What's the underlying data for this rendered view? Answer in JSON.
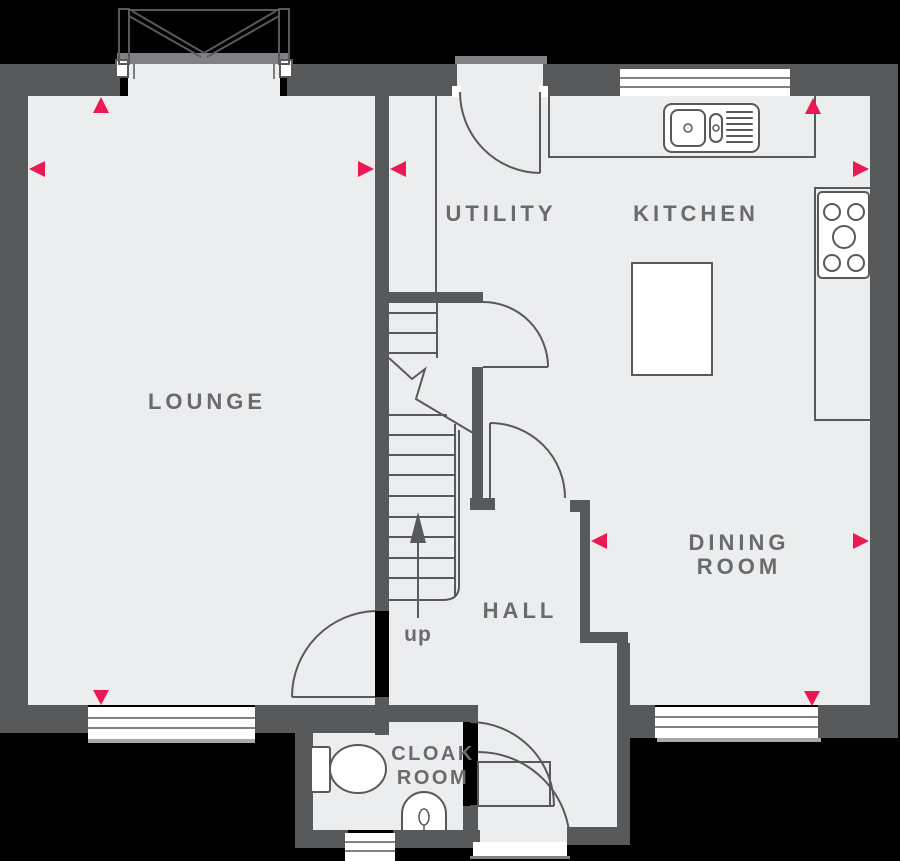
{
  "plan": {
    "type": "floorplan",
    "rooms": {
      "lounge": {
        "label": "LOUNGE"
      },
      "utility": {
        "label": "UTILITY"
      },
      "kitchen": {
        "label": "KITCHEN"
      },
      "dining": {
        "label_line1": "DINING",
        "label_line2": "ROOM"
      },
      "hall": {
        "label": "HALL"
      },
      "cloakroom": {
        "label_line1": "CLOAK",
        "label_line2": "ROOM"
      }
    },
    "stairs": {
      "direction_label": "up"
    },
    "fixtures": [
      "french-doors",
      "back-door",
      "front-door",
      "kitchen-sink",
      "hob",
      "kitchen-island",
      "worktop",
      "toilet",
      "basin",
      "stairs"
    ],
    "windows": [
      "kitchen-rear",
      "lounge-front",
      "dining-front",
      "cloakroom-front"
    ],
    "markers": [
      {
        "location": "lounge-top-wall",
        "direction": "up"
      },
      {
        "location": "lounge-left-wall",
        "direction": "left"
      },
      {
        "location": "centre-wall-left",
        "direction": "right"
      },
      {
        "location": "centre-wall-right",
        "direction": "left"
      },
      {
        "location": "kitchen-top-wall",
        "direction": "up"
      },
      {
        "location": "kitchen-right-wall",
        "direction": "right"
      },
      {
        "location": "dining-hall-wall",
        "direction": "left"
      },
      {
        "location": "dining-right-wall",
        "direction": "right"
      },
      {
        "location": "lounge-bottom-wall",
        "direction": "down"
      },
      {
        "location": "dining-bottom-wall",
        "direction": "down"
      }
    ]
  },
  "colors": {
    "background": "#000000",
    "wall": "#58595B",
    "floor": "#ECEDEE",
    "line": "#58595B",
    "marker": "#EB1953",
    "label_text": "#6A6B6D",
    "sill": "#A7A9AC",
    "outer_sill": "#808184",
    "fixture_fill": "#FFFFFF"
  }
}
